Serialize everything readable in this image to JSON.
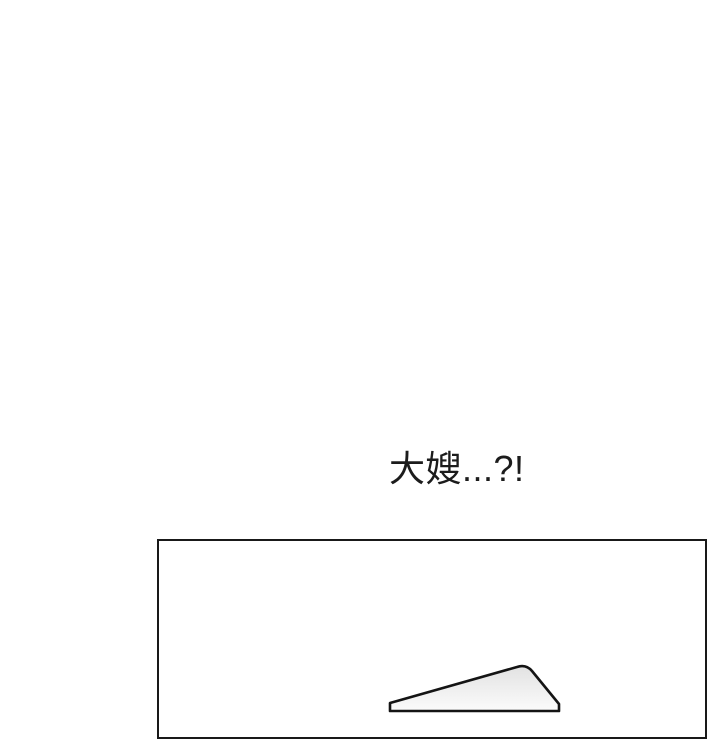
{
  "colors": {
    "background": "#ffffff"
  },
  "dialogue": {
    "text": "大嫂...?!",
    "text_color": "#1c1c1c"
  },
  "panel": {
    "border_color": "#191919",
    "artwork": {
      "shape_name": "draped-fabric-edge",
      "stroke_color": "#141414",
      "fill_top": "#e2e2e2",
      "fill_bottom": "#fbfbfb"
    }
  }
}
